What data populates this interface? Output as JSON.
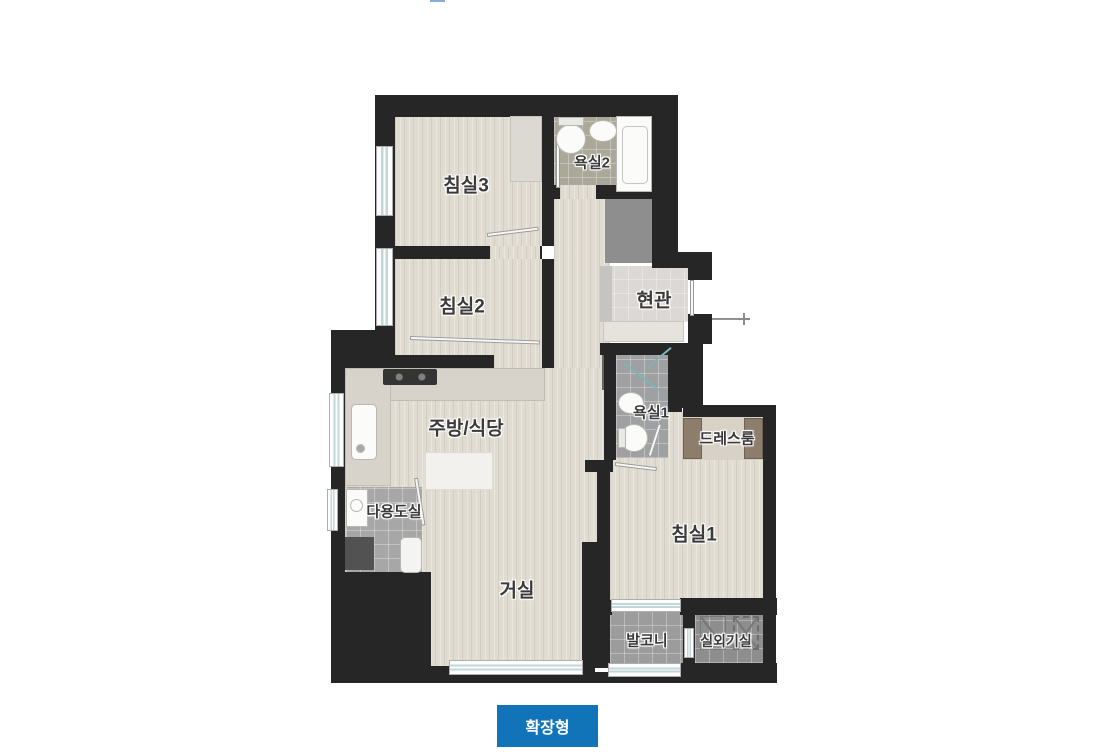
{
  "rooms": [
    {
      "id": "bedroom3",
      "label": "침실3"
    },
    {
      "id": "bathroom2",
      "label": "욕실2"
    },
    {
      "id": "bedroom2",
      "label": "침실2"
    },
    {
      "id": "entrance",
      "label": "현관"
    },
    {
      "id": "kitchen-dining",
      "label": "주방/식당"
    },
    {
      "id": "bathroom1",
      "label": "욕실1"
    },
    {
      "id": "dressroom",
      "label": "드레스룸"
    },
    {
      "id": "utility",
      "label": "다용도실"
    },
    {
      "id": "bedroom1",
      "label": "침실1"
    },
    {
      "id": "living",
      "label": "거실"
    },
    {
      "id": "balcony",
      "label": "발코니"
    },
    {
      "id": "outdoor-unit",
      "label": "실외기실"
    }
  ],
  "footer": {
    "button_label": "확장형"
  },
  "colors": {
    "accent_blue": "#1173b8",
    "wall": "#262626",
    "wood_floor": "#e1dcd2",
    "bath2_tile": "#aaa899",
    "bath1_tile": "#9fa0a2",
    "balcony_tile": "#9c9c9c",
    "entrance_tile": "#dbd8d5",
    "shaft_gray": "#8e8e8e"
  }
}
